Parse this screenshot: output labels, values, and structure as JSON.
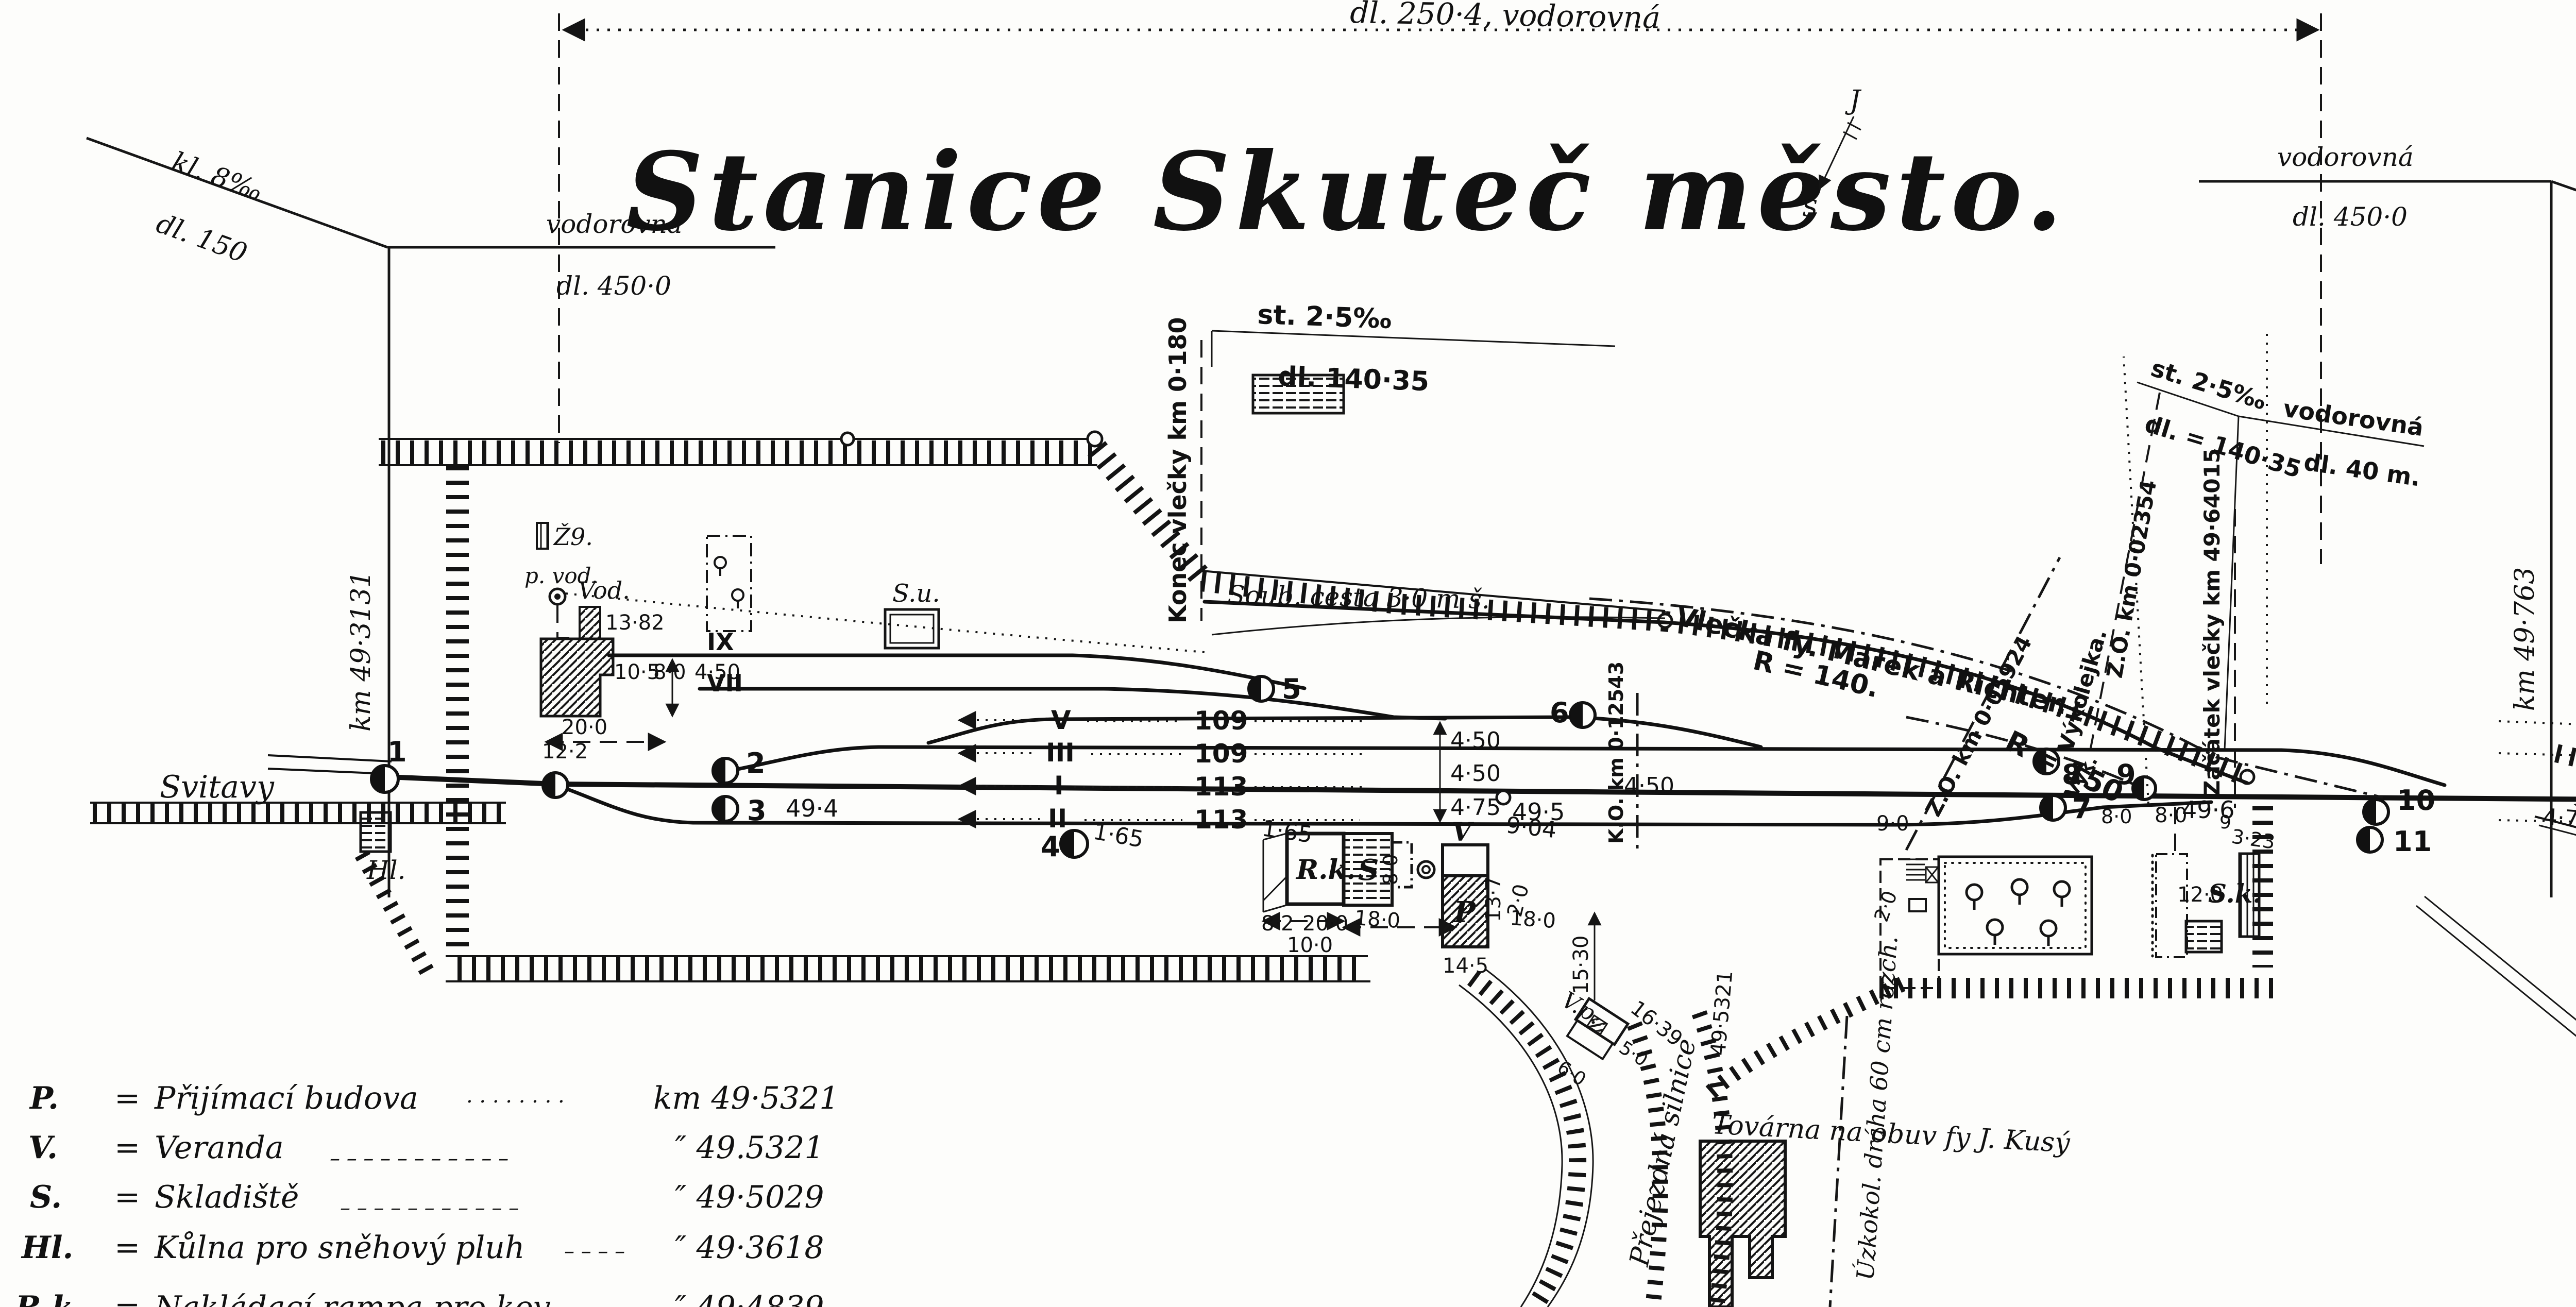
{
  "title": "Stanice Skuteč město.",
  "top_dimension": "dl. 250·4, vodorovná",
  "compass": {
    "j": "J",
    "s": "S"
  },
  "gradients": {
    "left": {
      "kl": "kl. 8‰",
      "dl": "dl. 150",
      "vodorovna": "vodorovná",
      "dl450": "dl. 450·0",
      "km": "km 49·3131"
    },
    "right": {
      "vodorovna": "vodorovná",
      "dl450": "dl. 450·0",
      "kl": "kl. 10‰",
      "dl300": "dl. 300",
      "km": "km 49·763"
    },
    "mid": {
      "st": "st. 2·5‰",
      "dl": "dl. 140·35"
    },
    "right_mid": {
      "st": "st. 2·5‰",
      "dl": "dl. = 140·35",
      "vodorovna": "vodorovná",
      "dl40": "dl. 40 m."
    }
  },
  "lines": {
    "konec_vlecky": "Konec vlečky km 0·180",
    "zacatek_vlecky": "Začátek vlečky km 49·64015",
    "vlecka": "Vlečka fy. Marek a Richter.",
    "r140": "R = 140.",
    "r150": "R = 150",
    "vykolejka": "Výkolejka.",
    "vyk": "Vyk.",
    "zo1": "Z.O. km 0·05924",
    "zo2": "Z.O. km 0·02354",
    "ko": "K.O. km 0·12543"
  },
  "roads": {
    "soub": "Soub. cesta 3·0 m š.",
    "prejezdna": "Přejezdná silnice",
    "uzkokolejka": "Úzkokol. dráha 60 cm rozch."
  },
  "places": {
    "svitavy": "Svitavy",
    "skutec": "Skuteč.",
    "kam_lomu": "ku kam. lomu",
    "tovarna": "Továrna na obuv fy J. Kusý"
  },
  "buildings": {
    "z9": "Ž9.",
    "p_vod": "p. vod.",
    "vod": "Vod.",
    "su": "S.u.",
    "rk": "R.k.",
    "s": "S",
    "v": "V",
    "p": "P",
    "hl": "Hl.",
    "sk": "S.k.",
    "vp": "V.p."
  },
  "tracks": {
    "v": "V",
    "iii": "III",
    "i": "I",
    "ii": "II",
    "ix": "IX",
    "vii": "VII",
    "len_v": "109",
    "len_iii": "109",
    "len_i": "113",
    "len_ii": "113"
  },
  "switches": {
    "s1": "1",
    "s2": "2",
    "s3": "3",
    "s4": "4",
    "s5": "5",
    "s6": "6",
    "s7": "7",
    "s8": "8",
    "s9": "9",
    "s10": "10",
    "s11": "11"
  },
  "kms": {
    "k494": "49·4",
    "k495": "49·5",
    "k496": "49·6",
    "k496b": "9",
    "k495321": "49·5321"
  },
  "dims": {
    "d450a": "4·50",
    "d450b": "4·50",
    "d475": "4·75",
    "d450c": "4·50",
    "d475b": "4·75",
    "d165a": "1·65",
    "d165b": "1·65",
    "d1382": "13·82",
    "d105": "10·5",
    "d80a": "8·0",
    "d450d": "4·50",
    "d200": "20·0",
    "d122": "12·2",
    "d100": "10·0",
    "d82": "8·2",
    "d180a": "18·0",
    "d180b": "18·0",
    "d1530": "15·30",
    "d1639": "16·39",
    "d137": "13·7",
    "d145": "14·5",
    "d90a": "9·04",
    "d90b": "9·0",
    "d20a": "2·0",
    "d20b": "2·0",
    "d80b": "8·0",
    "d80c": "8·0",
    "d80d": "8·0",
    "d120": "12·0",
    "d323": "3·23",
    "d60": "6·0",
    "d50": "5·0"
  },
  "legend": {
    "rows": [
      {
        "abbr": "P.",
        "eq": "=",
        "name": "Přijímací budova",
        "dots": "· · · · · · · ·",
        "km": "km 49·5321"
      },
      {
        "abbr": "V.",
        "eq": "=",
        "name": "Veranda",
        "dots": "– – – – – – – – – – –",
        "km": "″ 49.5321"
      },
      {
        "abbr": "S.",
        "eq": "=",
        "name": "Skladiště",
        "dots": "– – – – – – – – – – –",
        "km": "″ 49·5029"
      },
      {
        "abbr": "Hl.",
        "eq": "=",
        "name": "Kůlna pro sněhový pluh",
        "dots": "– – – –",
        "km": "″ 49·3618"
      },
      {
        "abbr": "R.k.",
        "eq": "=",
        "name": "Nakládací rampa pro kov",
        "dots": "– –",
        "km": "″ 49·4839"
      }
    ]
  }
}
